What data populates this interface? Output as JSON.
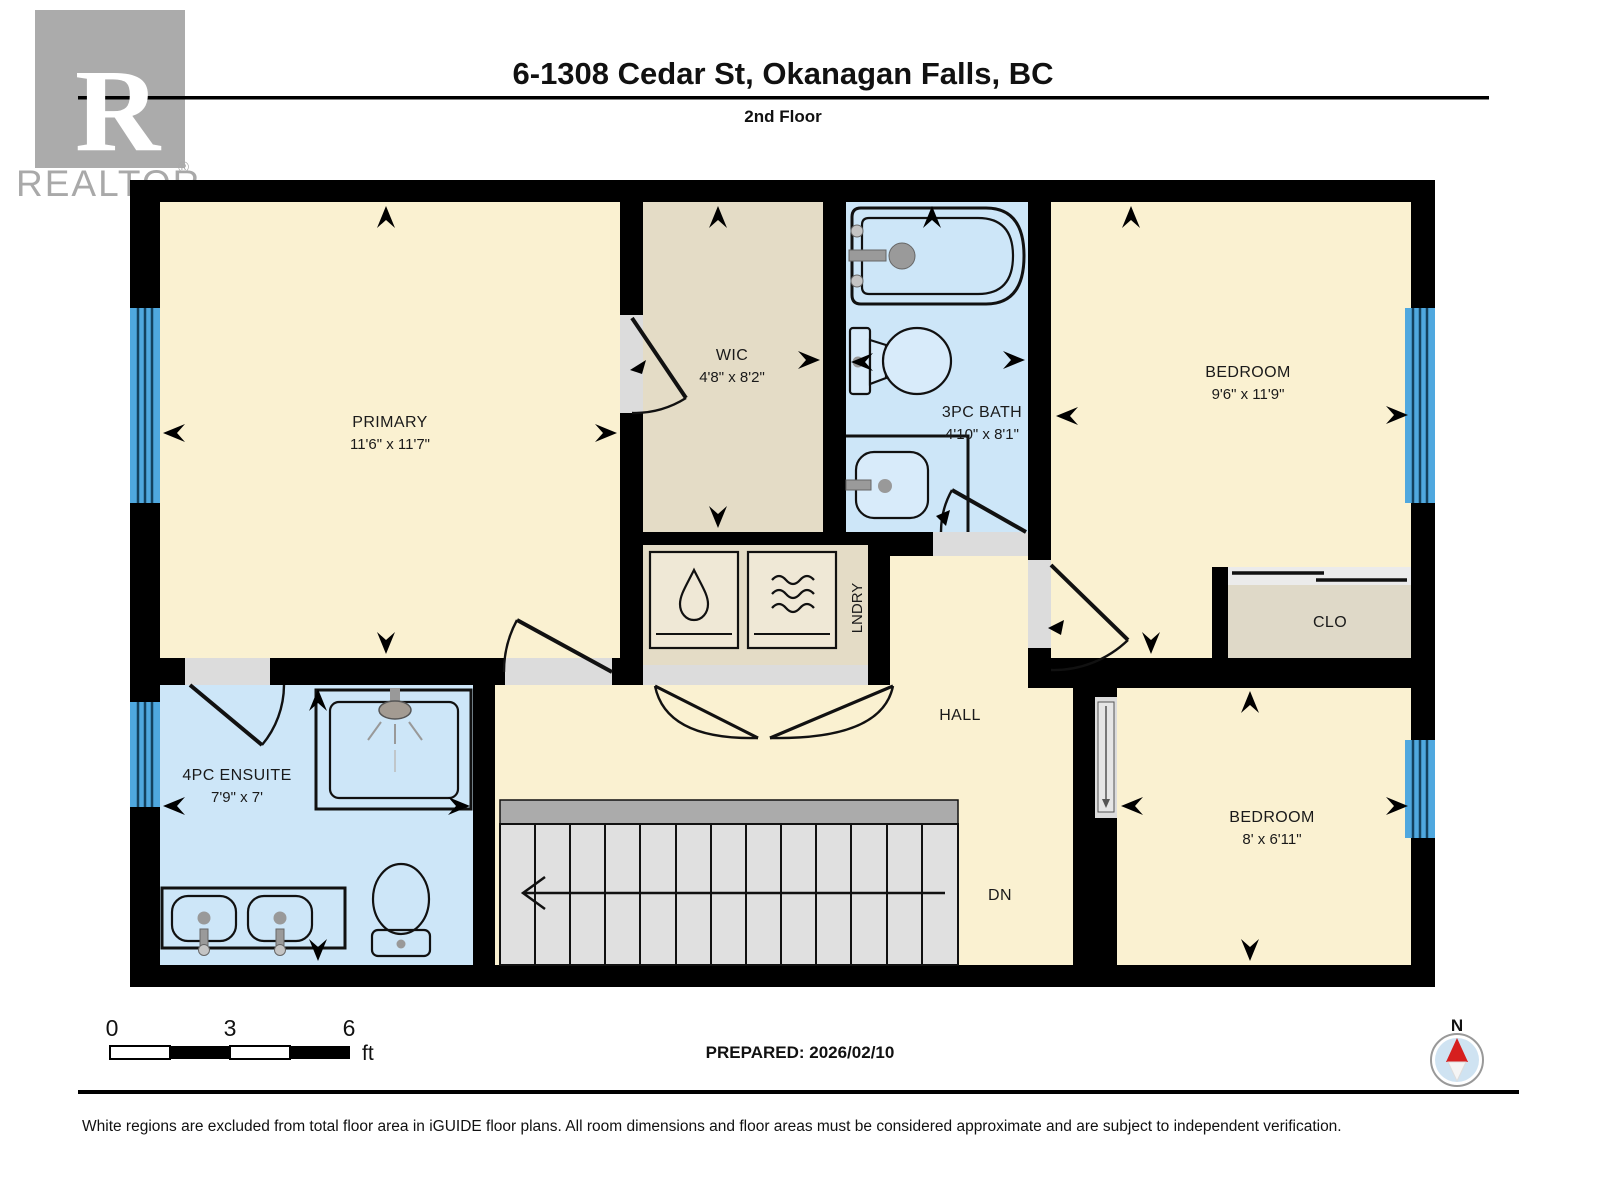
{
  "header": {
    "title": "6-1308 Cedar St, Okanagan Falls, BC",
    "floor": "2nd Floor"
  },
  "logo": {
    "letter": "R",
    "brand": "REALTOR",
    "registered": "®"
  },
  "rooms": {
    "primary": {
      "name": "PRIMARY",
      "dims": "11'6\" x 11'7\""
    },
    "wic": {
      "name": "WIC",
      "dims": "4'8\" x 8'2\""
    },
    "bath": {
      "name": "3PC BATH",
      "dims": "4'10\" x 8'1\""
    },
    "bedroom_top": {
      "name": "BEDROOM",
      "dims": "9'6\" x 11'9\""
    },
    "closet": {
      "name": "CLO"
    },
    "laundry": {
      "name": "LNDRY"
    },
    "hall": {
      "name": "HALL"
    },
    "ensuite": {
      "name": "4PC ENSUITE",
      "dims": "7'9\" x 7'"
    },
    "bedroom_bottom": {
      "name": "BEDROOM",
      "dims": "8' x 6'11\""
    },
    "stairs": {
      "label": "DN"
    }
  },
  "scale_bar": {
    "tick_0": "0",
    "tick_3": "3",
    "tick_6": "6",
    "unit": "ft"
  },
  "compass": {
    "label": "N"
  },
  "footer": {
    "prepared": "PREPARED: 2026/02/10",
    "disclaimer": "White regions are excluded from total floor area in iGUIDE floor plans. All room dimensions and floor areas must be considered approximate and are subject to independent verification."
  },
  "colors": {
    "room_fill": "#FAF1D1",
    "closet_fill": "#E4DCC6",
    "bath_fill": "#CDE6F8",
    "window_glass": "#4FA8DF",
    "wall": "#000000",
    "stair_fill": "#E0E0E0",
    "stair_band": "#ABABAB",
    "threshold": "#DCDCDC",
    "compass_north": "#D61F1F",
    "compass_disc": "#CFE3F2",
    "logo_grey": "#A9A9A9"
  }
}
